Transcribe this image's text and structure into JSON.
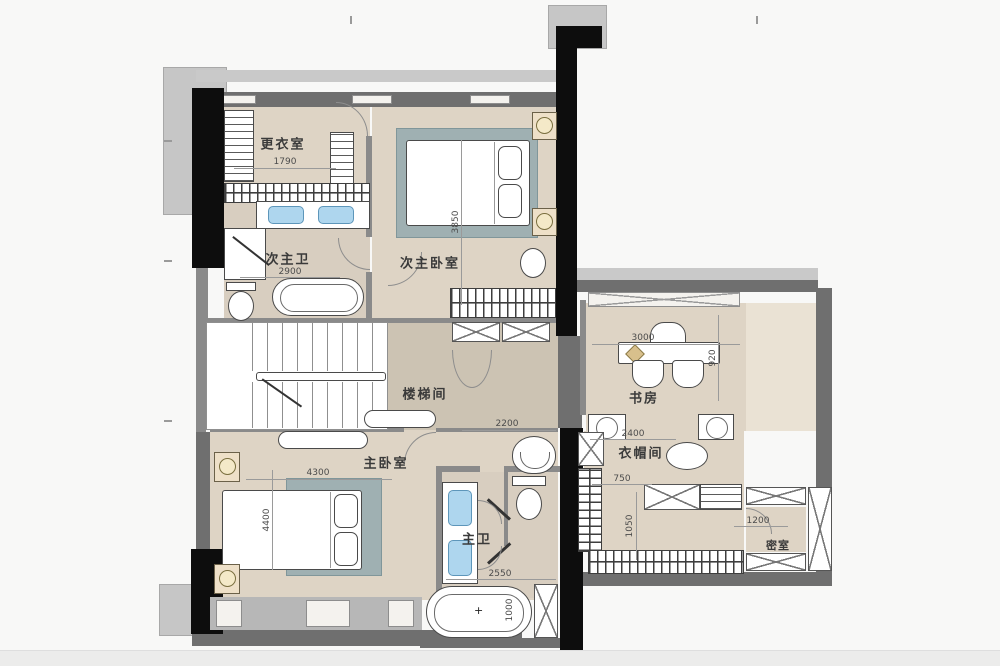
{
  "plan_title": "second-floor residential plan",
  "rooms": {
    "dressing": {
      "label": "更衣室"
    },
    "second_master_bath": {
      "label": "次主卫"
    },
    "second_master_bedroom": {
      "label": "次主卧室"
    },
    "stairwell": {
      "label": "楼梯间"
    },
    "master_bedroom": {
      "label": "主卧室"
    },
    "master_bath": {
      "label": "主卫"
    },
    "study": {
      "label": "书房"
    },
    "cloakroom": {
      "label": "衣帽间"
    },
    "secret_room": {
      "label": "密室"
    }
  },
  "dimensions_mm": {
    "dressing_width": "1790",
    "second_master_bath_width": "2900",
    "second_master_bedroom_depth": "3850",
    "hall_width": "2200",
    "master_bedroom_width": "4300",
    "master_bedroom_depth": "4400",
    "master_bath_width": "2550",
    "master_bath_tub_width": "1000",
    "study_width": "3000",
    "study_depth": "920",
    "cloakroom_width": "2400",
    "cloakroom_opening": "750",
    "cloakroom_depth": "1050",
    "secret_room_width": "1200"
  },
  "colors": {
    "floor_beige": "#ded4c5",
    "floor_hall": "#ccc3b3",
    "wall_gray": "#6f6f6f",
    "wall_black": "#0d0d0d",
    "rug_blue_gray": "#9fb0b2",
    "sink_blue": "#aed6ee"
  }
}
